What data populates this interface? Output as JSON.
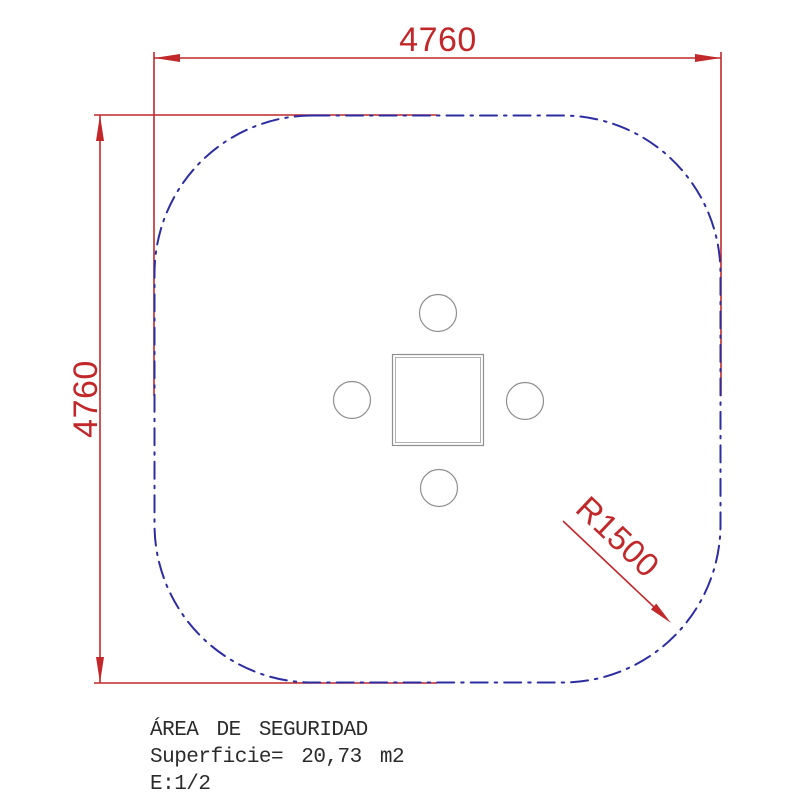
{
  "colors": {
    "dimension_red": "#c2282a",
    "boundary_blue": "#2d2da2",
    "equipment_gray": "#8f8f8f",
    "text_dark": "#2b2b2b"
  },
  "dimensions": {
    "width_label": "4760",
    "height_label": "4760",
    "radius_label": "R1500"
  },
  "notes": {
    "area_title": "ÁREA DE SEGURIDAD",
    "surface": "Superficie= 20,73 m2",
    "scale": "E:1/2"
  }
}
